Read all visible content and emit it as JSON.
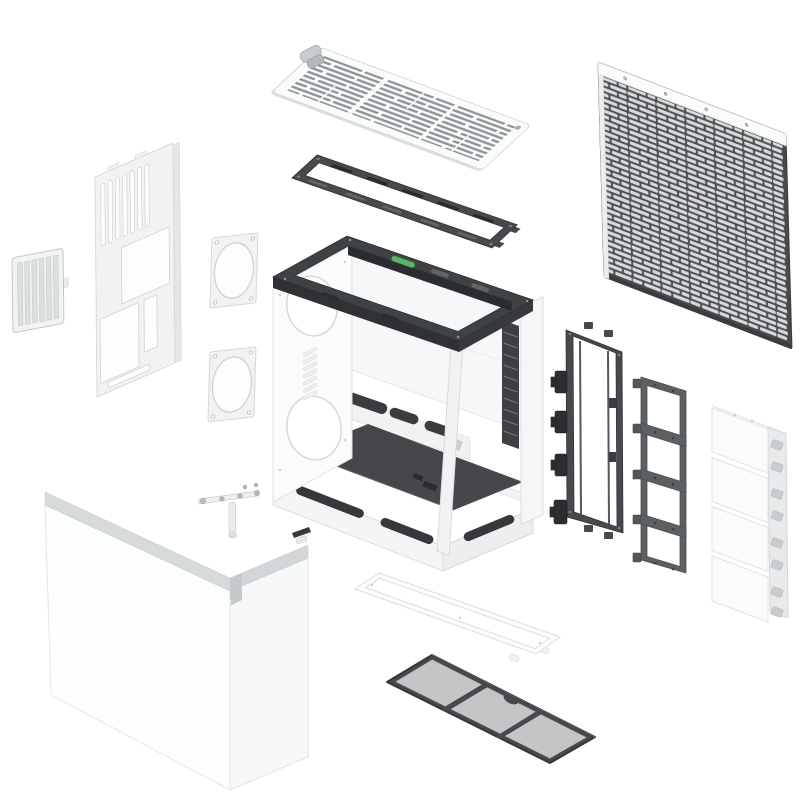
{
  "title": "PC case exploded assembly view",
  "colors": {
    "bg": "#ffffff",
    "white": "#fafbfb",
    "white2": "#f1f2f3",
    "white3": "#e7e9ea",
    "cutout": "#fdfdfd",
    "edge": "#d5d8d9",
    "edge2": "#c3c6c8",
    "dark": "#47494c",
    "darker": "#313336",
    "mid": "#5c6063",
    "slotgray": "#8f9498",
    "meshslot": "#d9dadb",
    "filtermesh": "#c3c5c7",
    "floor": "#45474a",
    "green": "#5cb567",
    "screw": "#9aa0a4"
  },
  "parts": [
    {
      "id": "top-vent-panel",
      "label": "Top vent panel"
    },
    {
      "id": "top-panel-latch",
      "label": "Top panel latch clip"
    },
    {
      "id": "top-fan-bracket",
      "label": "Top fan radiator bracket"
    },
    {
      "id": "front-mesh-panel",
      "label": "Front mesh panel"
    },
    {
      "id": "rear-panel",
      "label": "Rear vented panel"
    },
    {
      "id": "side-vent-filter",
      "label": "Side vent filter"
    },
    {
      "id": "fan-adapter-plate-upper",
      "label": "Fan adapter plate"
    },
    {
      "id": "fan-adapter-plate-lower",
      "label": "Fan adapter plate"
    },
    {
      "id": "main-chassis",
      "label": "Main chassis frame with power button"
    },
    {
      "id": "side-fan-bracket",
      "label": "Side fan bracket with clips"
    },
    {
      "id": "fan-mounting-rail",
      "label": "Fan mounting rail ladder"
    },
    {
      "id": "modular-panel-stack",
      "label": "Modular side panel sections"
    },
    {
      "id": "wraparound-panels",
      "label": "Wrap-around outer panels"
    },
    {
      "id": "corner-clip",
      "label": "Corner clip"
    },
    {
      "id": "support-bracket",
      "label": "Support bracket with screws"
    },
    {
      "id": "bottom-filter-frame",
      "label": "Bottom filter frame"
    },
    {
      "id": "bottom-dust-filter",
      "label": "Bottom dust filter"
    }
  ]
}
